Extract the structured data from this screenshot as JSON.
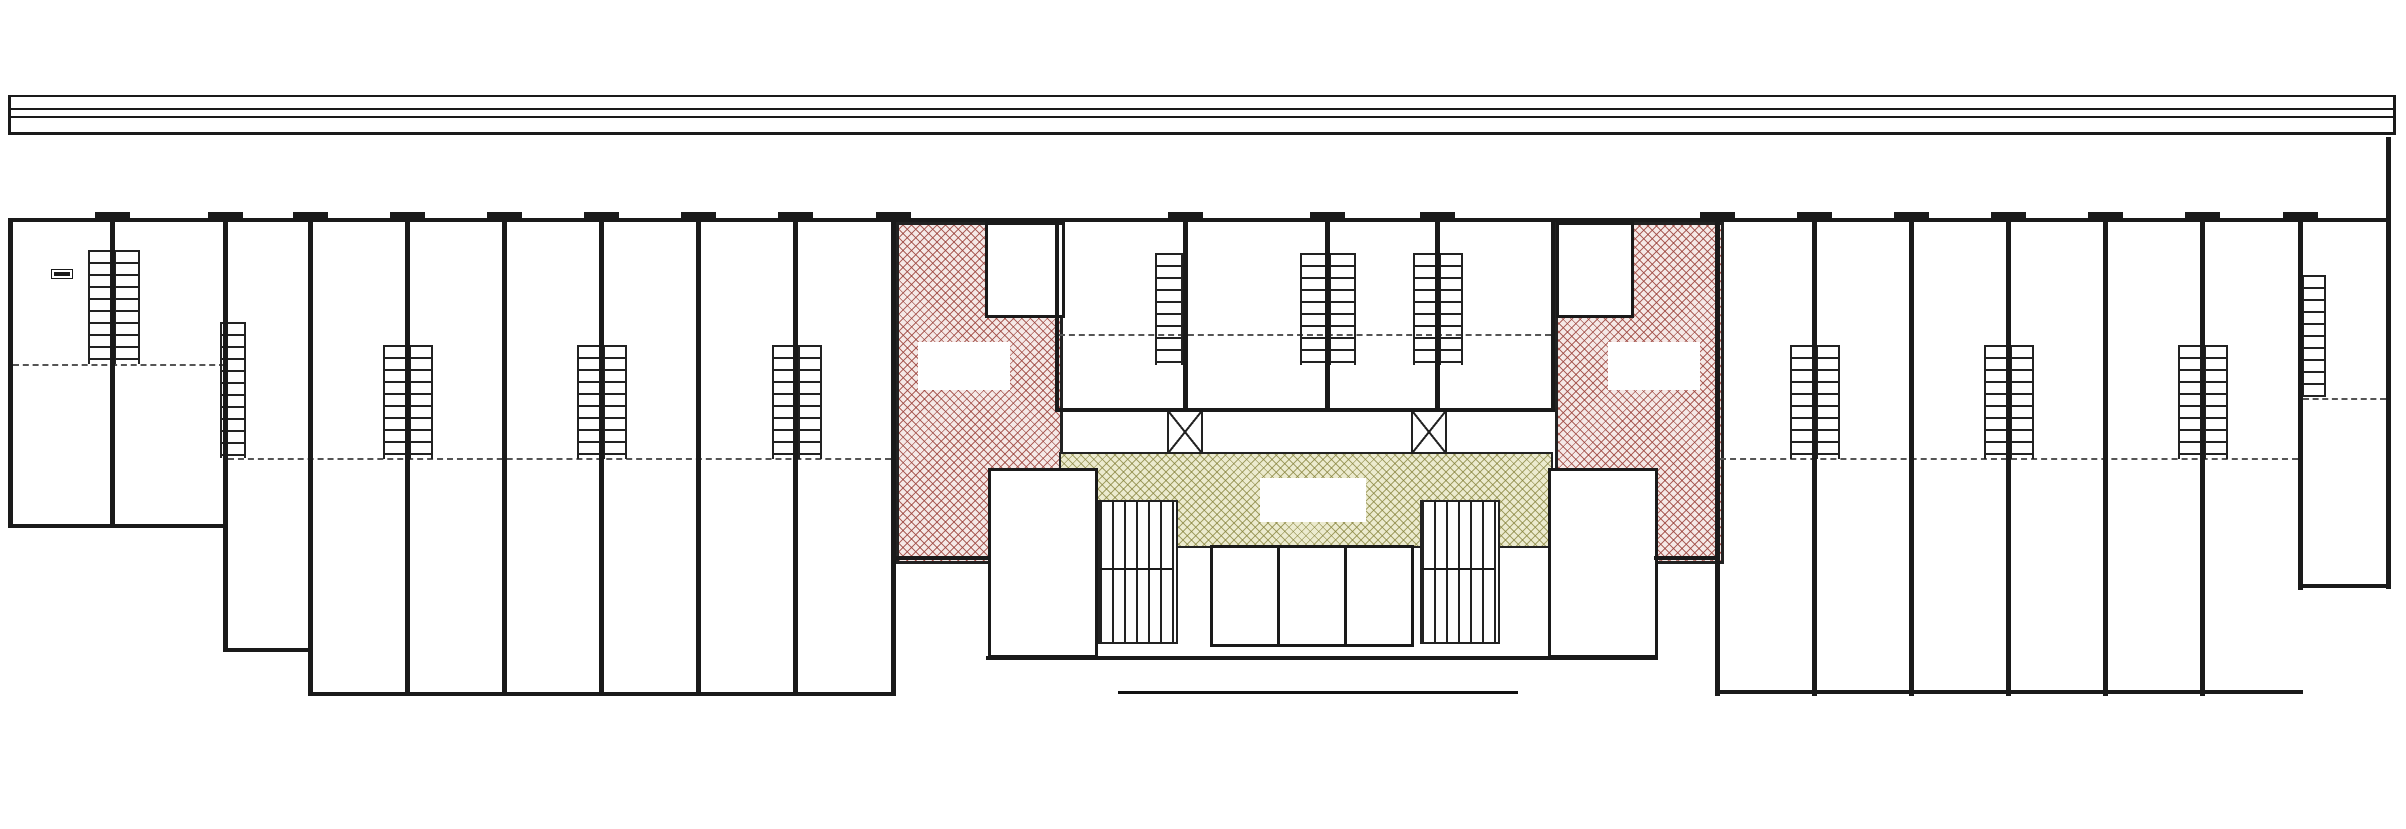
{
  "title": {
    "text": "GROUND FLOOR PLAN"
  },
  "watermark": {
    "text": "Housiey.com"
  },
  "colors": {
    "red_hatch": "#9a4039",
    "green_hatch": "#838038",
    "wall": "#1a1a1a",
    "dim_text": "#8f8f8f"
  },
  "labels": {
    "shop": "SHOP",
    "mez_above": "(MEZ ABOVE)",
    "entrance_lines": [
      "ENTRANCE",
      "LOBBY"
    ],
    "lift": "LIFT",
    "lift_dim": "1.90 X 2.50",
    "lift_dim_ft": "(6'3\" X 8'2\")",
    "toilet": "TOILET",
    "toilet_dim": "1.52 X 1.20",
    "toilet_dim_ft": "(5'0\" X 3'11\")",
    "passage": "PASSAGE",
    "passage_dim": "1.40 X 1.32",
    "passage_dim_ft": "(4'7\" X 4'4\")",
    "water_room_1_lines": [
      "COMM",
      "WATER",
      "ROOM 1"
    ],
    "water_room_2_lines": [
      "COMM",
      "WATER",
      "ROOM 2"
    ]
  },
  "shops": [
    {
      "num": "01",
      "dim": "3.35 X 9.27",
      "ft": "(11'0\" X 30'5\")"
    },
    {
      "num": "02",
      "dim": "3.35 X 9.27",
      "ft": "(11'0\" X 30'5\")"
    },
    {
      "num": "03",
      "dim": "3.05 X 12.61",
      "ft": "(10'0\" X 41'5\")"
    },
    {
      "num": "04",
      "dim": "3.05 X 14.17",
      "ft": "(10'0\" X 46'6\")"
    },
    {
      "num": "05",
      "dim": "3.05 X 14.17",
      "ft": "(10'0\" X 46'6\")"
    },
    {
      "num": "06",
      "dim": "3.05 X 14.17",
      "ft": "(10'0\" X 46'6\")"
    },
    {
      "num": "07",
      "dim": "3.05 X 14.17",
      "ft": "(10'0\" X 46'6\")"
    },
    {
      "num": "08",
      "dim": "3.05 X 14.17",
      "ft": "(10'0\" X 46'6\")"
    },
    {
      "num": "09",
      "dim": "3.05 X 14.17",
      "ft": "(10'0\" X 46'6\")"
    },
    {
      "num": "10",
      "dim": "4.05 X 7.43",
      "ft": "(13'3\" X 24'5\")"
    },
    {
      "num": "11",
      "dim": "4.69 X 7.43",
      "ft": "(15'5\" X 24'5\")"
    },
    {
      "num": "12",
      "dim": "3.23 X 7.43",
      "ft": "(10'7\" X 24'5\")"
    },
    {
      "num": "13",
      "dim": "4.05 X 7.43",
      "ft": "(13'3\" X 24'5\")"
    },
    {
      "num": "14",
      "dim": "3.05 X 14.17",
      "ft": "(10'0\" X 46'6\")"
    },
    {
      "num": "15",
      "dim": "3.05 X 14.17",
      "ft": "(10'0\" X 46'6\")"
    },
    {
      "num": "16",
      "dim": "3.05 X 14.17",
      "ft": "(10'0\" X 46'6\")"
    },
    {
      "num": "17",
      "dim": "3.05 X 14.17",
      "ft": "(10'0\" X 46'6\")"
    },
    {
      "num": "18",
      "dim": "3.05 X 14.17",
      "ft": "(10'0\" X 46'6\")"
    },
    {
      "num": "19",
      "dim": "3.05 X 14.17",
      "ft": "(10'0\" X 46'6\")"
    },
    {
      "num": "20",
      "dim": "3.05 X 9.67",
      "ft": "(10'0\" X 31'9\")"
    }
  ]
}
